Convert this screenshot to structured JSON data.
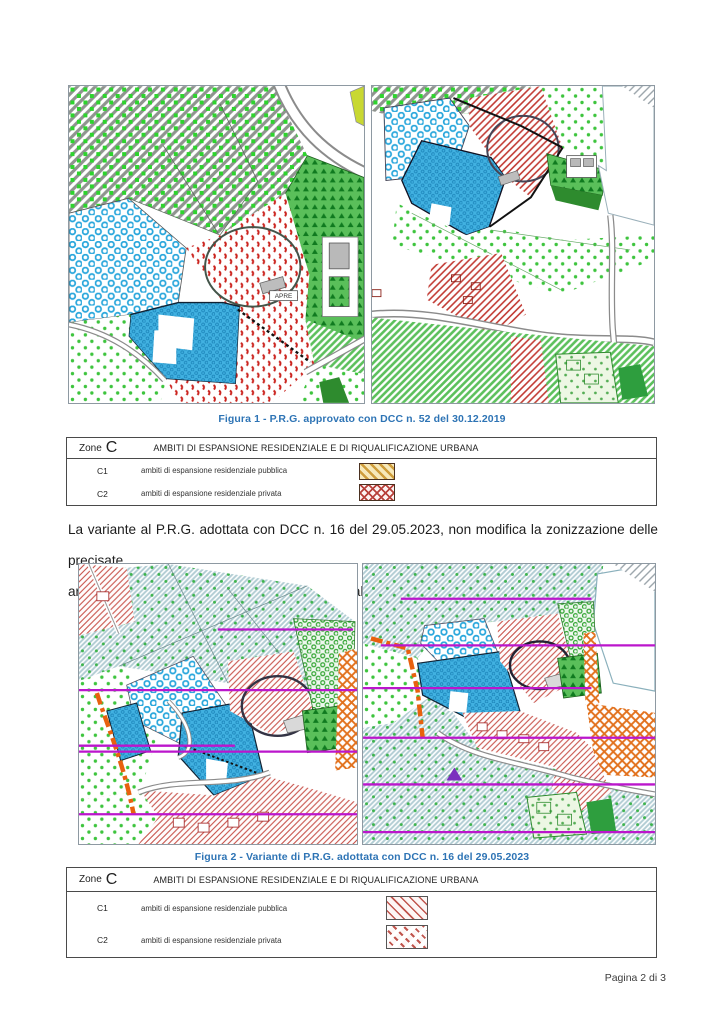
{
  "figure1": {
    "caption": "Figura 1 - P.R.G. approvato con DCC n. 52 del 30.12.2019",
    "map_label": "APRE"
  },
  "legend1": {
    "zone_word": "Zone",
    "zone_letter": "C",
    "header": "AMBITI DI ESPANSIONE RESIDENZIALE E DI RIQUALIFICAZIONE URBANA",
    "rows": [
      {
        "code": "C1",
        "label": "ambiti di espansione residenziale pubblica"
      },
      {
        "code": "C2",
        "label": "ambiti di espansione residenziale privata"
      }
    ]
  },
  "body_text": {
    "line1": "La variante al P.R.G. adottata con DCC n. 16 del 29.05.2023, non modifica la zonizzazione delle precisate",
    "line2": "aree, ma le assoggetta ad un Ambito Residenziale con Prescrizioni Esecutive non attivo."
  },
  "figure2": {
    "caption": "Figura 2 - Variante di P.R.G. adottata con DCC n. 16 del 29.05.2023"
  },
  "legend2": {
    "zone_word": "Zone",
    "zone_letter": "C",
    "header": "AMBITI DI ESPANSIONE RESIDENZIALE E DI RIQUALIFICAZIONE URBANA",
    "rows": [
      {
        "code": "C1",
        "label": "ambiti di espansione residenziale pubblica"
      },
      {
        "code": "C2",
        "label": "ambiti di espansione residenziale privata"
      }
    ]
  },
  "footer": {
    "page_indicator": "Pagina 2 di 3"
  },
  "colors": {
    "caption_blue": "#2E74B5",
    "magenta_overlay": "#BB16CC",
    "orange_boundary": "#E8610E",
    "map_blue": "#41B1E1",
    "map_red": "#C23B34",
    "map_green": "#3DC43D",
    "legend_c1_fill": "#F7E9BA",
    "legend_c1_hatch": "#CF9D3B",
    "legend_red_hatch": "#B8403A"
  }
}
